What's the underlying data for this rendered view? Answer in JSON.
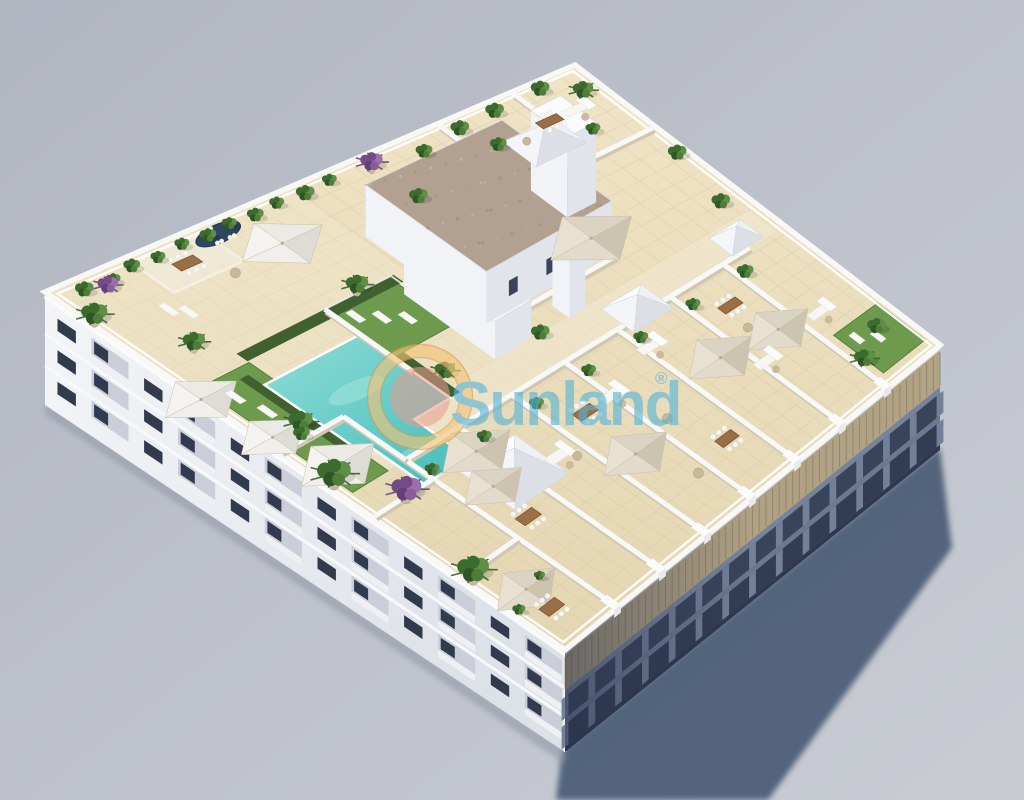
{
  "meta": {
    "type": "3d-architectural-aerial-render",
    "subject": "New-build apartment block seen from above with rooftop solarium, swimming pool, lawns and private furnished terraces"
  },
  "watermark": {
    "brand": "Sunland",
    "registered_mark": "®"
  },
  "palette": {
    "background": "#b2b6c1",
    "background_light": "#c9ccd3",
    "ground_shadow": "#4d5e78",
    "facade_light_top": "#f4f5f8",
    "facade_light_bottom": "#dde1e8",
    "facade_shade_dark": "#46516a",
    "facade_shade_light": "#8b96a8",
    "window_glass": "#313b4d",
    "louver_wood": "#b3a383",
    "parapet_white": "#f8f8f7",
    "tile_light": "#f0e4c6",
    "tile_dark": "#e4d6b2",
    "tile_line": "#d6c7a1",
    "walkway": "#f0e7d1",
    "pool_deep": "#46bdbb",
    "pool_shallow": "#8fdcd6",
    "lawn_green": "#6d9a4d",
    "hedge_green": "#41602f",
    "plant_green": "#4e7d3a",
    "plant_purple": "#8a5c99",
    "wood_furniture": "#9a6f45",
    "canopy_cream": "#d9d1bf",
    "canopy_white": "#efeeea",
    "gravel_roof": "#b2a090",
    "spa_navy": "#2e4660",
    "logo_ring_yellow": "#f3c477",
    "logo_disc_pink": "#e89b8e",
    "logo_text_blue": "#55b4d6"
  }
}
